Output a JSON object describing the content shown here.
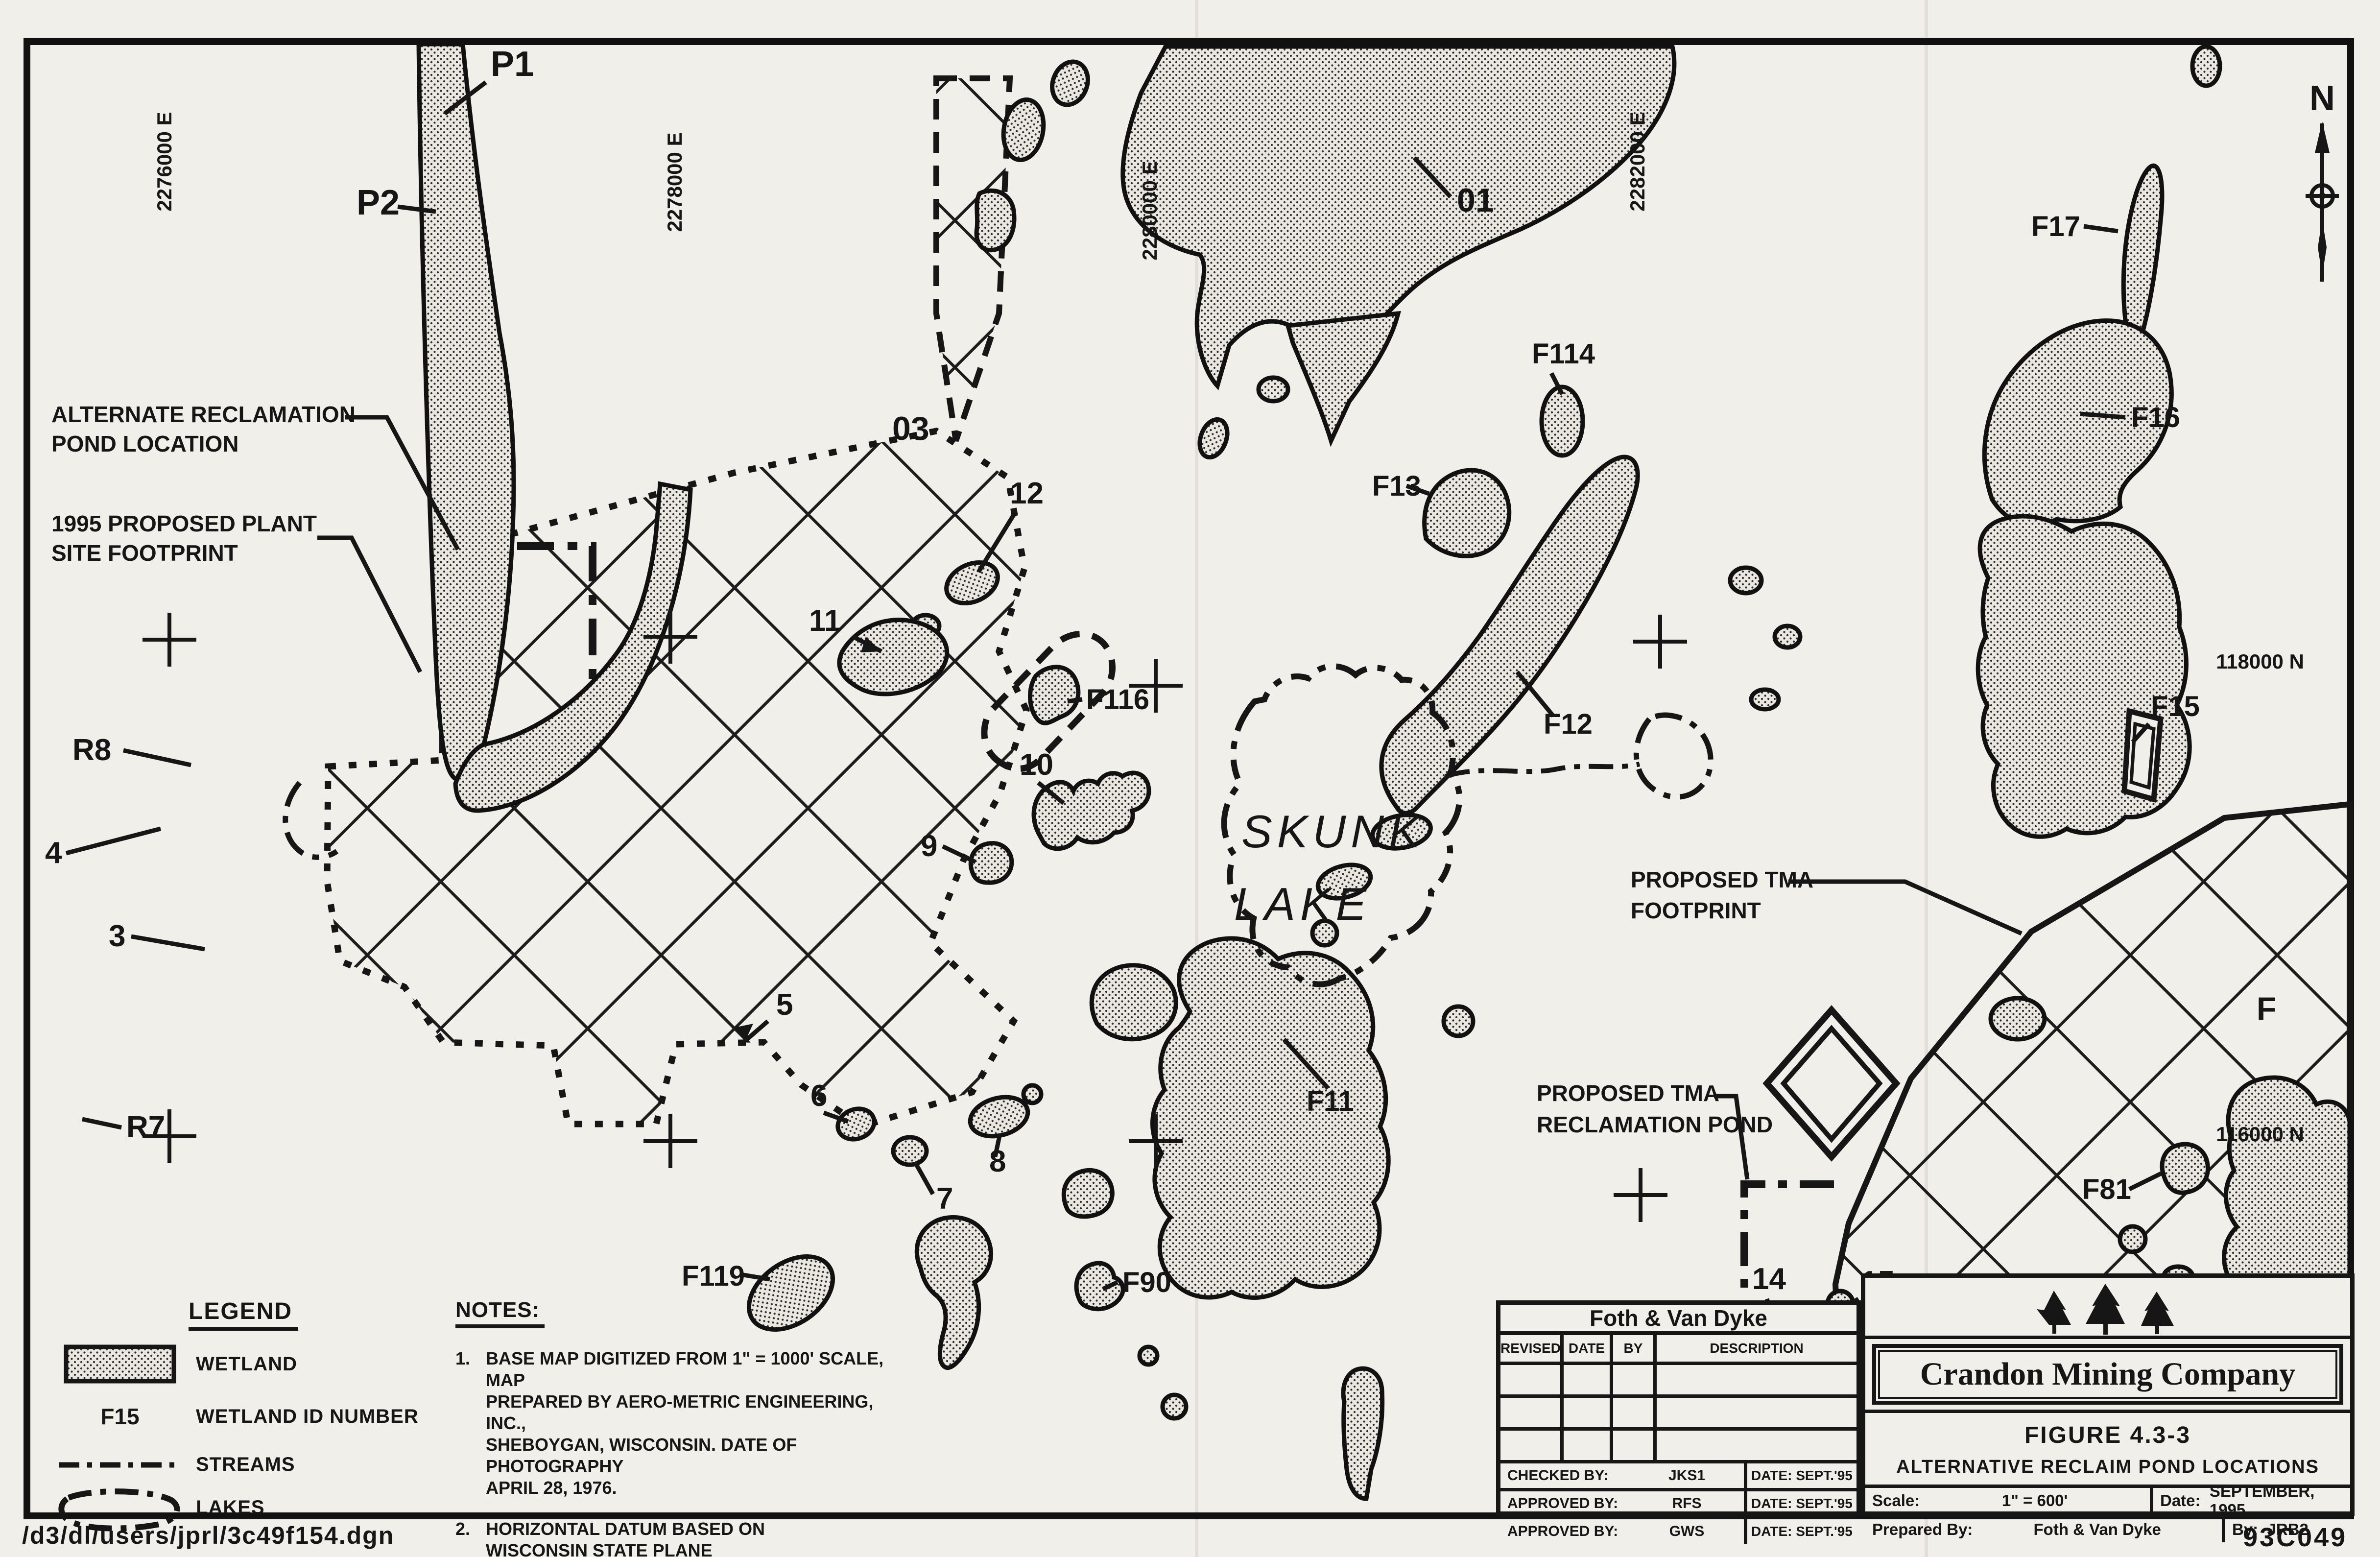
{
  "page": {
    "file_path": "/d3/dl/users/jprl/3c49f154.dgn"
  },
  "map": {
    "north_label": "N",
    "coordinate_labels": [
      {
        "text": "2276000 E"
      },
      {
        "text": "2278000 E"
      },
      {
        "text": "2280000 E"
      },
      {
        "text": "2282000 E"
      },
      {
        "text": "118000 N"
      },
      {
        "text": "116000 N"
      },
      {
        "text": "F"
      }
    ],
    "lake": {
      "name_line1": "SKUNK",
      "name_line2": "LAKE"
    },
    "wetland_labels": [
      {
        "text": "P1"
      },
      {
        "text": "P2"
      },
      {
        "text": "01"
      },
      {
        "text": "03"
      },
      {
        "text": "12"
      },
      {
        "text": "11"
      },
      {
        "text": "F116"
      },
      {
        "text": "10"
      },
      {
        "text": "9"
      },
      {
        "text": "F13"
      },
      {
        "text": "F114"
      },
      {
        "text": "F12"
      },
      {
        "text": "F17"
      },
      {
        "text": "F16"
      },
      {
        "text": "F15"
      },
      {
        "text": "F11"
      },
      {
        "text": "F81"
      },
      {
        "text": "F90"
      },
      {
        "text": "F119"
      },
      {
        "text": "R8"
      },
      {
        "text": "4"
      },
      {
        "text": "3"
      },
      {
        "text": "R7"
      },
      {
        "text": "5"
      },
      {
        "text": "6"
      },
      {
        "text": "7"
      },
      {
        "text": "8"
      },
      {
        "text": "14"
      },
      {
        "text": "15"
      }
    ],
    "annotations": {
      "alt_pond": [
        "ALTERNATE RECLAMATION",
        "POND LOCATION"
      ],
      "plant": [
        "1995 PROPOSED PLANT",
        "SITE FOOTPRINT"
      ],
      "tma": [
        "PROPOSED TMA",
        "FOOTPRINT"
      ],
      "tma_pond": [
        "PROPOSED TMA",
        "RECLAMATION POND"
      ]
    }
  },
  "legend": {
    "title": "LEGEND",
    "wetland_label": "WETLAND",
    "id_symbol": "F15",
    "id_label": "WETLAND ID NUMBER",
    "streams_label": "STREAMS",
    "lakes_label": "LAKES"
  },
  "notes": {
    "title": "NOTES:",
    "note1_num": "1.",
    "note1_lines": [
      "BASE MAP DIGITIZED FROM 1\" = 1000' SCALE, MAP",
      "PREPARED BY AERO-METRIC ENGINEERING, INC.,",
      "SHEBOYGAN, WISCONSIN. DATE OF PHOTOGRAPHY",
      "APRIL 28, 1976."
    ],
    "note2_num": "2.",
    "note2_lines": [
      "HORIZONTAL DATUM BASED ON",
      "WISCONSIN STATE PLANE",
      "COORDINATE SYSTEM - NORTH ZONE."
    ]
  },
  "title_block": {
    "company": "Foth & Van Dyke",
    "columns": [
      "REVISED",
      "DATE",
      "BY",
      "DESCRIPTION"
    ],
    "sign_rows": [
      {
        "label": "CHECKED BY:",
        "value": "JKS1",
        "date_label": "DATE:",
        "date": "SEPT.'95"
      },
      {
        "label": "APPROVED BY:",
        "value": "RFS",
        "date_label": "DATE:",
        "date": "SEPT.'95"
      },
      {
        "label": "APPROVED BY:",
        "value": "GWS",
        "date_label": "DATE:",
        "date": "SEPT.'95"
      }
    ]
  },
  "figure_block": {
    "company": "Crandon Mining Company",
    "figure_title": "FIGURE 4.3-3",
    "figure_subtitle": "ALTERNATIVE RECLAIM POND LOCATIONS",
    "scale_label": "Scale:",
    "scale": "1\" = 600'",
    "date_label": "Date:",
    "date": "SEPTEMBER, 1995",
    "prepared_label": "Prepared By:",
    "prepared": "Foth & Van Dyke",
    "by_label": "By:",
    "by": "JRB2",
    "drawing_number": "93C049"
  }
}
